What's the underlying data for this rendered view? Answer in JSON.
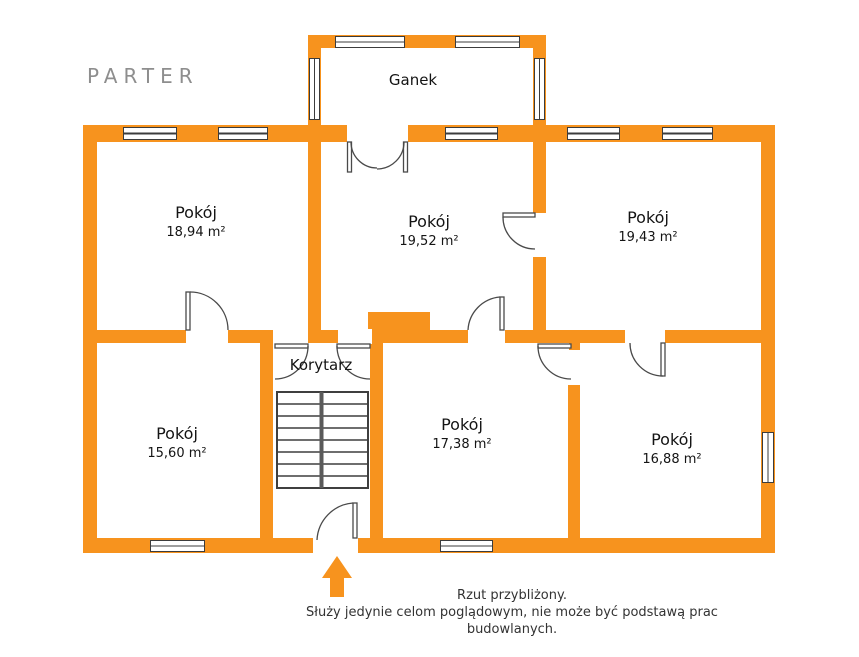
{
  "floor_plan": {
    "title": "PARTER",
    "rooms": [
      {
        "name": "Ganek",
        "area": ""
      },
      {
        "name": "Pokój",
        "area": "18,94 m²"
      },
      {
        "name": "Pokój",
        "area": "19,52 m²"
      },
      {
        "name": "Pokój",
        "area": "19,43 m²"
      },
      {
        "name": "Korytarz",
        "area": ""
      },
      {
        "name": "Pokój",
        "area": "15,60 m²"
      },
      {
        "name": "Pokój",
        "area": "17,38 m²"
      },
      {
        "name": "Pokój",
        "area": "16,88 m²"
      }
    ],
    "disclaimer": {
      "line1": "Rzut przybliżony.",
      "line2": "Służy jedynie celom poglądowym, nie może być podstawą prac budowlanych."
    },
    "colors": {
      "wall": "#F7931E",
      "title_text": "#8E8E8E",
      "label_text": "#141414",
      "disclaimer_text": "#333333"
    }
  }
}
